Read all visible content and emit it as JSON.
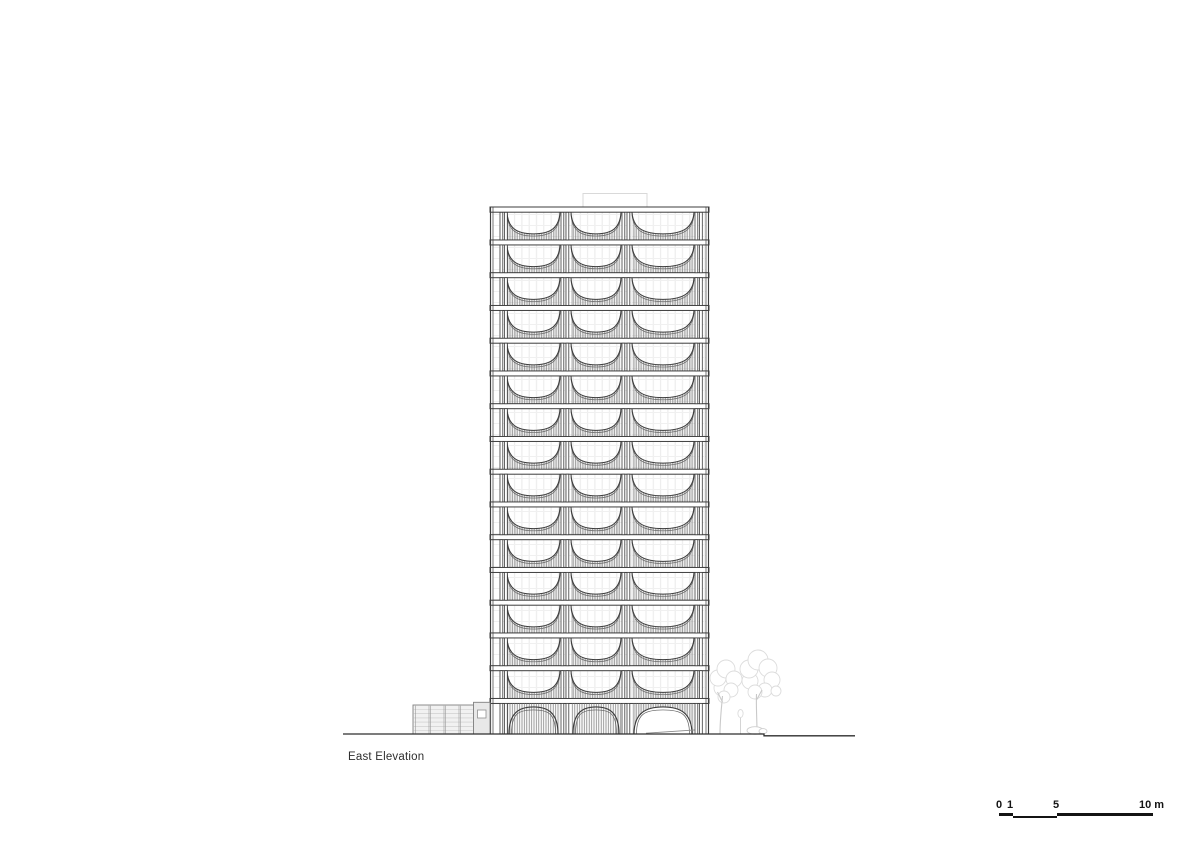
{
  "title": {
    "label": "East Elevation"
  },
  "scale_bar": {
    "labels": [
      "0",
      "1",
      "5",
      "10 m"
    ],
    "unit": "m",
    "marks": [
      0,
      1,
      5,
      10
    ]
  },
  "drawing": {
    "view": "east-elevation",
    "floors_above_ground": 15,
    "bays_per_floor": 3,
    "bay_widths": [
      53,
      50,
      62
    ],
    "ground_floor": {
      "type": "arched",
      "closed_arch_bays": 2,
      "open_arch_bays": 1
    },
    "site": {
      "annex_panels": 4,
      "trees": 2
    },
    "colors": {
      "line_strong": "#3d3d3d",
      "hatch": "#7d7d7d",
      "hatch_ground": "#7f7f7f",
      "faint": "#eaeaea",
      "bulkhead": "#d9d9d9",
      "annex_line": "#808080",
      "annex_fill": "#f1f1f1",
      "tree": "#dcdcdc",
      "trunk": "#c9c9c9",
      "ground_line": "#2f2f2f",
      "text": "#2e2e2e"
    }
  }
}
